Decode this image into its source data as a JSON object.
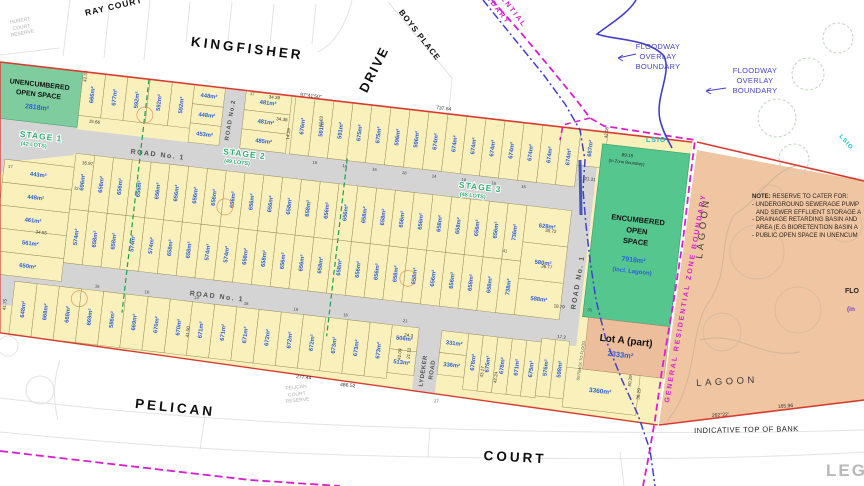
{
  "streets": {
    "kingfisher": "KINGFISHER",
    "drive": "DRIVE",
    "ray_court": "RAY COURT",
    "boys_place": "BOYS PLACE",
    "pelican": "PELICAN",
    "court": "COURT"
  },
  "reserves": {
    "hubert": [
      "HUBERT",
      "COURT",
      "RESERVE"
    ],
    "pelican": [
      "PELICAN",
      "COURT",
      "RESERVE"
    ]
  },
  "roads": {
    "road1": "ROAD No. 1",
    "road2": "ROAD No.2",
    "lydeker_1": "LYDEKER",
    "lydeker_2": "ROAD"
  },
  "stages": [
    {
      "label": "STAGE 1",
      "sub": "(42 LOTS)"
    },
    {
      "label": "STAGE 2",
      "sub": "(49 LOTS)"
    },
    {
      "label": "STAGE 3",
      "sub": "(48 LOTS)"
    }
  ],
  "open_spaces": {
    "unencumbered": {
      "line1": "UNENCUMBERED",
      "line2": "OPEN SPACE",
      "area": "2818m²"
    },
    "encumbered": {
      "line1": "ENCUMBERED",
      "line2": "OPEN",
      "line3": "SPACE",
      "area": "7918m²",
      "note": "(incl. Lagoon)"
    }
  },
  "lot_a": {
    "label": "Lot A (part)",
    "area": "2333m²"
  },
  "boundaries": {
    "floodway": [
      "FLOODWAY",
      "OVERLAY",
      "BOUNDARY"
    ],
    "zone_label": "GENERAL  RESIDENTIAL  ZONE  BOUNDARY",
    "zone_label_top": [
      "RESIDENTIAL",
      "BOUNDARY"
    ],
    "lsio": "LSIO",
    "zone_dim": "89.15",
    "zone_dim_sub": "(to Zone Boundary)",
    "indicative": "INDICATIVE TOP OF BANK",
    "lagoon": "LAGOON",
    "track": "SETBACK TO FLOOD"
  },
  "note": {
    "heading": "NOTE:",
    "intro": "RESERVE TO CATER FOR:",
    "items": [
      "- UNDERGROUND SEWERAGE PUMP",
      "  AND SEWER EFFLUENT STORAGE A",
      "- DRAINAGE RETARDING BASIN AND",
      "  AREA (E.G BIORETENTION BASIN A",
      "- PUBLIC OPEN SPACE IN UNENCUM"
    ]
  },
  "legend_label": "LEGEND",
  "edge_cut": {
    "flo": "FLO",
    "incl": "(in"
  },
  "lot_rows": {
    "top_left": [
      "666m²",
      "677m²",
      "592m²",
      "592m²",
      "592m²"
    ],
    "stack_448": [
      "448m²",
      "448m²",
      "453m²"
    ],
    "stack_481": [
      "481m²",
      "481m²",
      "485m²"
    ],
    "top_right": [
      "676m²",
      "591m²",
      "591m²",
      "675m²",
      "675m²",
      "596m²",
      "596m²",
      "674m²",
      "674m²",
      "674m²",
      "674m²",
      "674m²",
      "674m²",
      "674m²",
      "674m²"
    ],
    "corner_lot": "687m²",
    "west_column": [
      "443m²",
      "448m²",
      "461m²",
      "561m²",
      "650m²"
    ],
    "row_b": [
      "696m²",
      "656m²",
      "656m²",
      "656m²",
      "656m²",
      "656m²",
      "656m²",
      "656m²",
      "656m²",
      "656m²",
      "656m²",
      "658m²",
      "658m²",
      "656m²",
      "656m²",
      "658m²",
      "658m²",
      "656m²",
      "656m²",
      "658m²",
      "658m²",
      "656m²",
      "656m²",
      "736m²"
    ],
    "row_c": [
      "574m²",
      "658m²",
      "658m²",
      "574m²",
      "574m²",
      "658m²",
      "658m²",
      "574m²",
      "574m²",
      "658m²",
      "658m²",
      "656m²",
      "656m²",
      "658m²",
      "658m²",
      "656m²",
      "656m²",
      "658m²",
      "658m²",
      "656m²",
      "656m²",
      "658m²",
      "658m²",
      "738m²"
    ],
    "east_stack": [
      "628m²",
      "580m²",
      "588m²"
    ],
    "row_d": [
      "648m²",
      "668m²",
      "668m²",
      "669m²",
      "586m²",
      "669m²",
      "670m²",
      "670m²",
      "671m²",
      "671m²",
      "671m²",
      "672m²",
      "672m²",
      "672m²",
      "673m²",
      "673m²",
      "673m²"
    ],
    "stack_506": [
      "506m²",
      "513m²"
    ],
    "stack_331": [
      "331m²",
      "336m²"
    ],
    "row_d_east": [
      "678m²",
      "675m²",
      "678m²",
      "671m²",
      "675m²"
    ],
    "stack_576": [
      "576m²",
      "598m²"
    ],
    "lot_3360": "3360m²"
  },
  "dims_map": [
    "97°41'50\"",
    "737.64",
    "277.44",
    "486.52",
    "262°22'",
    "165.96"
  ],
  "dims_band": [
    "42.33",
    "15.66",
    "16.97",
    "34.55",
    "41.75",
    "34.39",
    "34.38",
    "14.29",
    "42.23",
    "42.08",
    "21.31",
    "35.72",
    "36.77",
    "18.79",
    "41.90",
    "50.29",
    "38.29",
    "42.24",
    "43.17",
    "42.09",
    "24.3",
    "21.12",
    "17.2"
  ],
  "dims_small": [
    "16",
    "14",
    "17",
    "18",
    "32",
    "41",
    "35",
    "21"
  ],
  "colors": {
    "lot_fill": "#f9f0bb",
    "lot_border": "#9a9060",
    "road_fill": "#d4d4d4",
    "green_open": "#7fcd9f",
    "green_encumbered": "#55c68e",
    "tan_lagoon": "#efc5a2",
    "red_boundary": "#d93a2f",
    "magenta_zone": "#d81fd0",
    "blue_flood": "#4340c6",
    "stage_green": "#2faf71",
    "area_blue": "#2b5fd9",
    "lsio_cyan": "#19bfd6"
  }
}
